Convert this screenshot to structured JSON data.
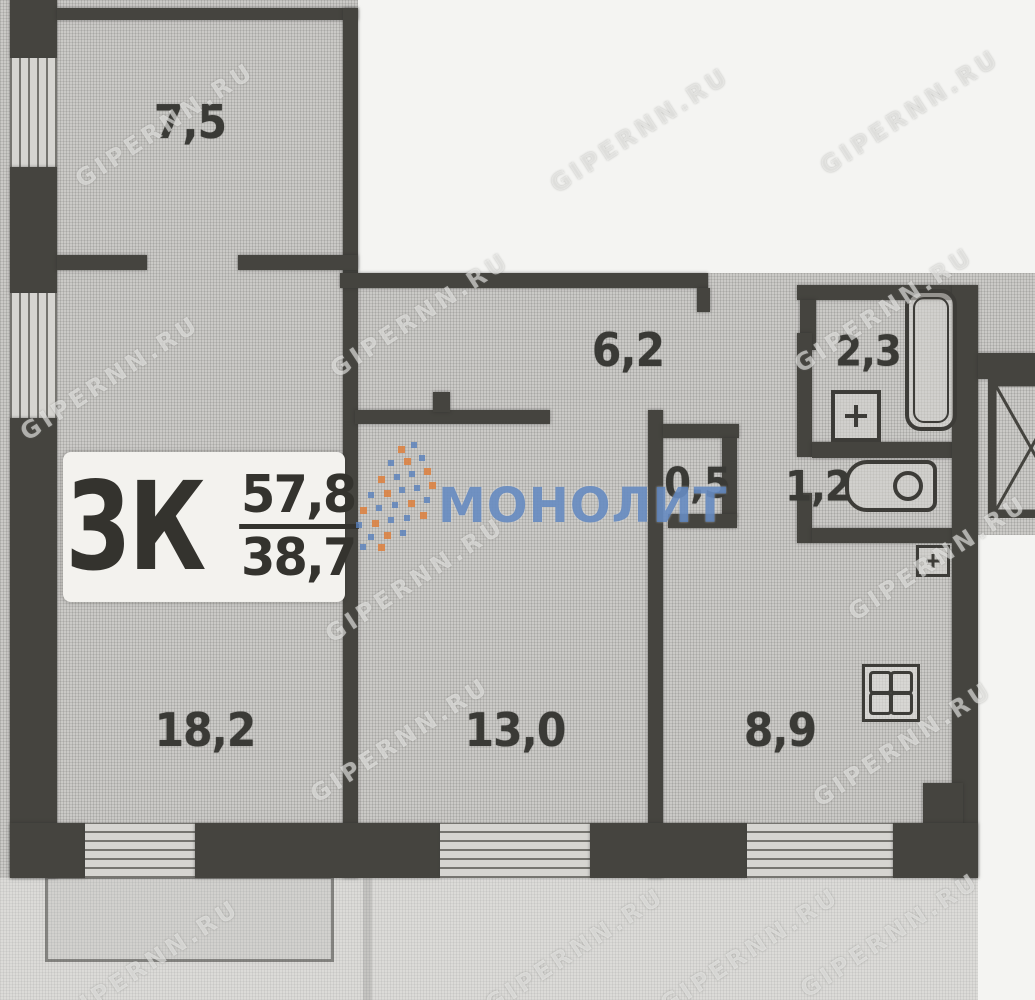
{
  "plan": {
    "apartment_type_label": "3К",
    "total_area": "57,8",
    "living_area": "38,7",
    "rooms": [
      {
        "name": "room-top-left",
        "area": "7,5"
      },
      {
        "name": "hallway",
        "area": "6,2"
      },
      {
        "name": "bathroom",
        "area": "2,3"
      },
      {
        "name": "storage",
        "area": "0,5"
      },
      {
        "name": "toilet",
        "area": "1,2"
      },
      {
        "name": "living-room-left",
        "area": "18,2"
      },
      {
        "name": "living-room-middle",
        "area": "13,0"
      },
      {
        "name": "kitchen",
        "area": "8,9"
      }
    ],
    "fixtures": [
      "bathtub",
      "bath-sink",
      "toilet-bowl",
      "kitchen-sink",
      "stove",
      "ventilation-shaft"
    ],
    "colors": {
      "wall": "#45443f",
      "plan_fill": "#cbcac7",
      "scan_white": "#f4f4f2",
      "sticker_bg": "#f3f2ee",
      "brand_blue": "#5880bc",
      "brand_orange": "#dd7f3c"
    }
  },
  "watermarks": {
    "site": "GIPERNN.RU",
    "brand": "МОНОЛИТ"
  }
}
